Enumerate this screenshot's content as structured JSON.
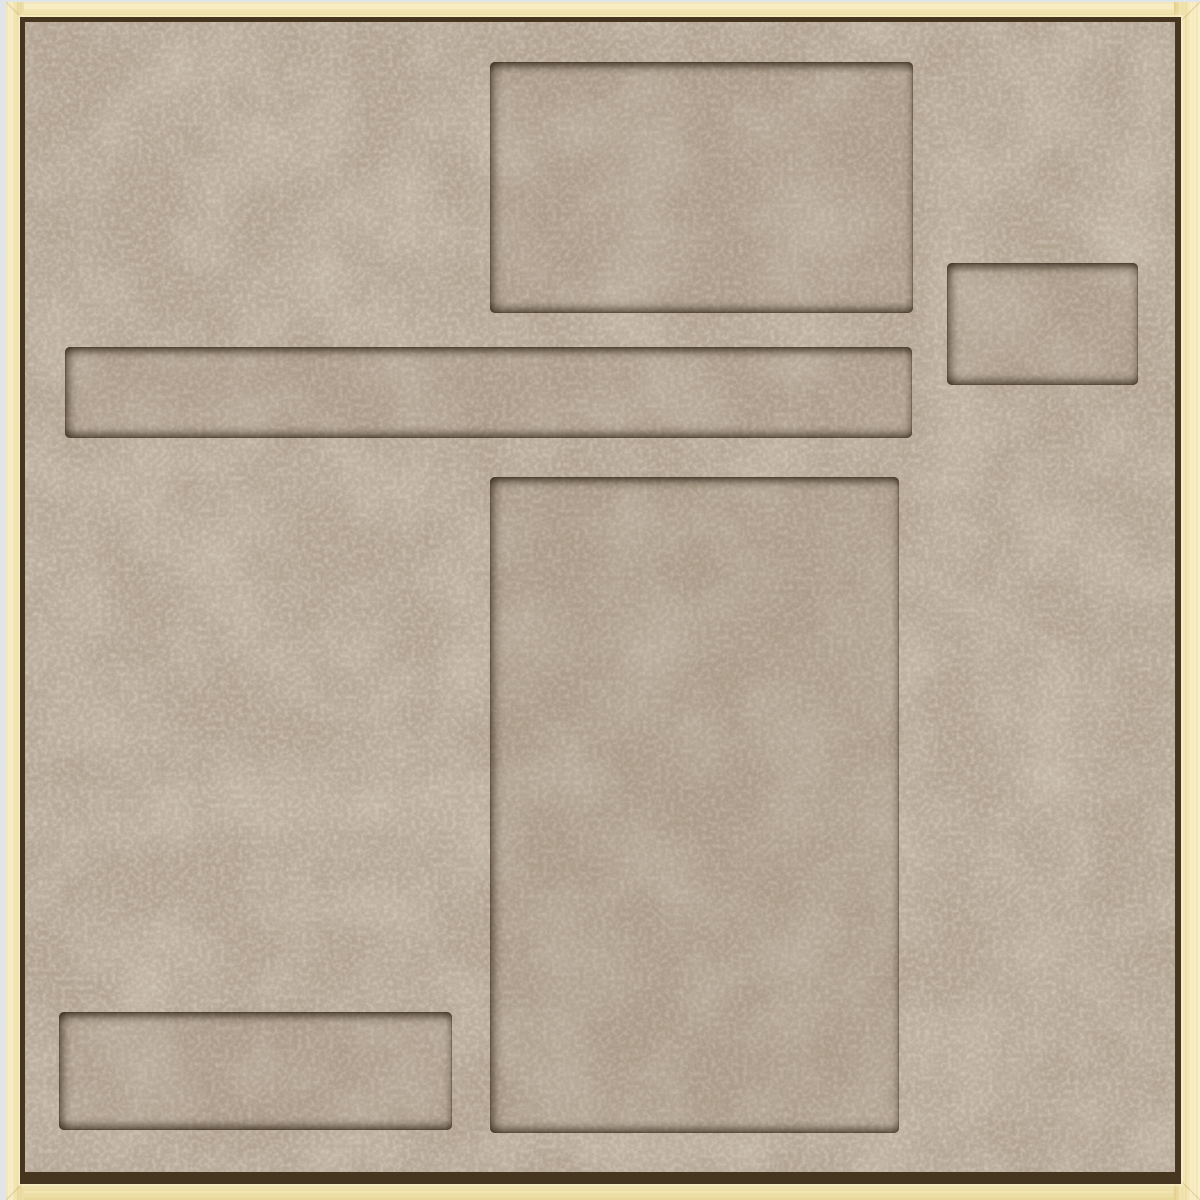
{
  "scene": {
    "title": "Beige felt organizer tray with recessed pockets inside a light wooden frame",
    "frame": {
      "label": "light wood frame"
    },
    "panel": {
      "label": "mottled beige felt panel"
    },
    "pockets": [
      {
        "label": "top center rectangular pocket"
      },
      {
        "label": "small top right rectangular pocket"
      },
      {
        "label": "long shallow horizontal slot"
      },
      {
        "label": "large central vertical pocket"
      },
      {
        "label": "bottom left rectangular pocket"
      }
    ]
  },
  "palette": {
    "backdrop": "#e0e5e8",
    "wood-light": "#faf1cd",
    "wood-mid": "#f0e2ab",
    "wood-dark": "#e6d394",
    "seam": "#46361f",
    "felt-base": "#b3a492",
    "felt-light": "#ddd2c2",
    "felt-dark": "#8d7c69",
    "pocket-shadow": "#281c0e"
  }
}
